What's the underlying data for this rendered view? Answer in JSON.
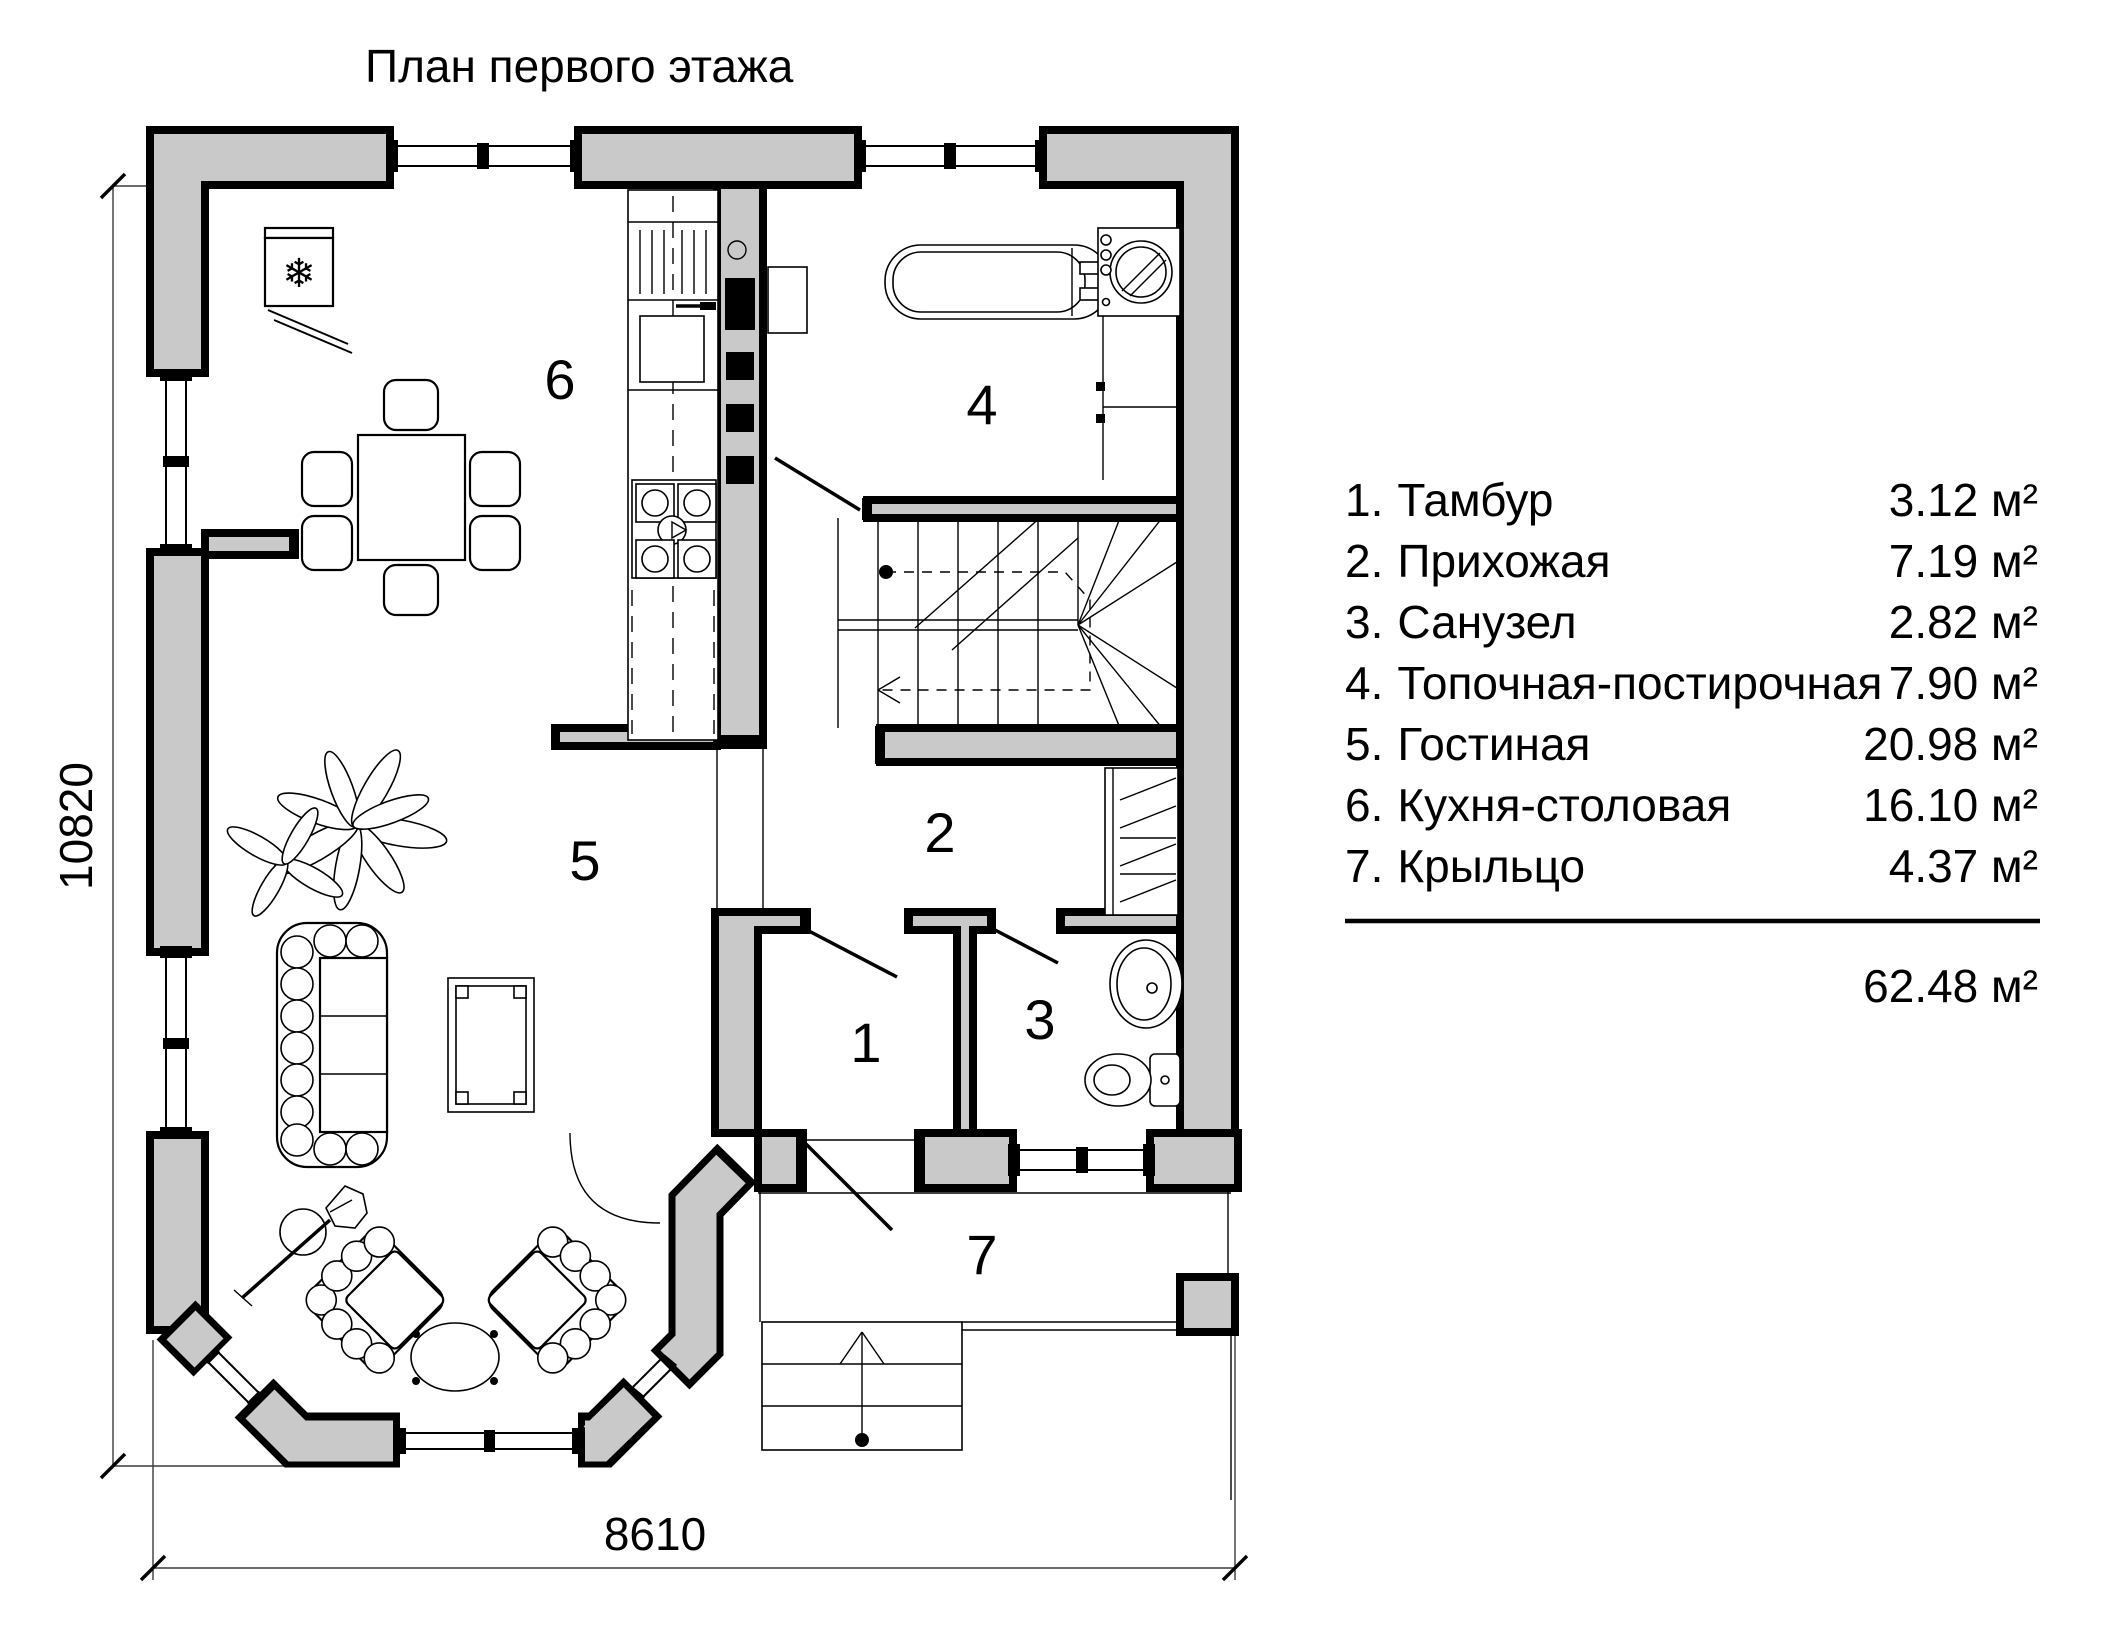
{
  "title": "План первого этажа",
  "rooms": [
    {
      "num": "1.",
      "name": "Тамбур",
      "area": "3.12 м²",
      "label": "1"
    },
    {
      "num": "2.",
      "name": "Прихожая",
      "area": "7.19 м²",
      "label": "2"
    },
    {
      "num": "3.",
      "name": "Санузел",
      "area": "2.82 м²",
      "label": "3"
    },
    {
      "num": "4.",
      "name": "Топочная-постирочная",
      "area": "7.90 м²",
      "label": "4"
    },
    {
      "num": "5.",
      "name": "Гостиная",
      "area": "20.98 м²",
      "label": "5"
    },
    {
      "num": "6.",
      "name": "Кухня-столовая",
      "area": "16.10 м²",
      "label": "6"
    },
    {
      "num": "7.",
      "name": "Крыльцо",
      "area": "4.37 м²",
      "label": "7"
    }
  ],
  "total_area": "62.48 м²",
  "dimensions": {
    "height_mm": "10820",
    "width_mm": "8610"
  },
  "colors": {
    "wall_fill": "#c9c9c9",
    "line": "#000000"
  },
  "icons": {
    "fridge_snowflake": "❄"
  }
}
